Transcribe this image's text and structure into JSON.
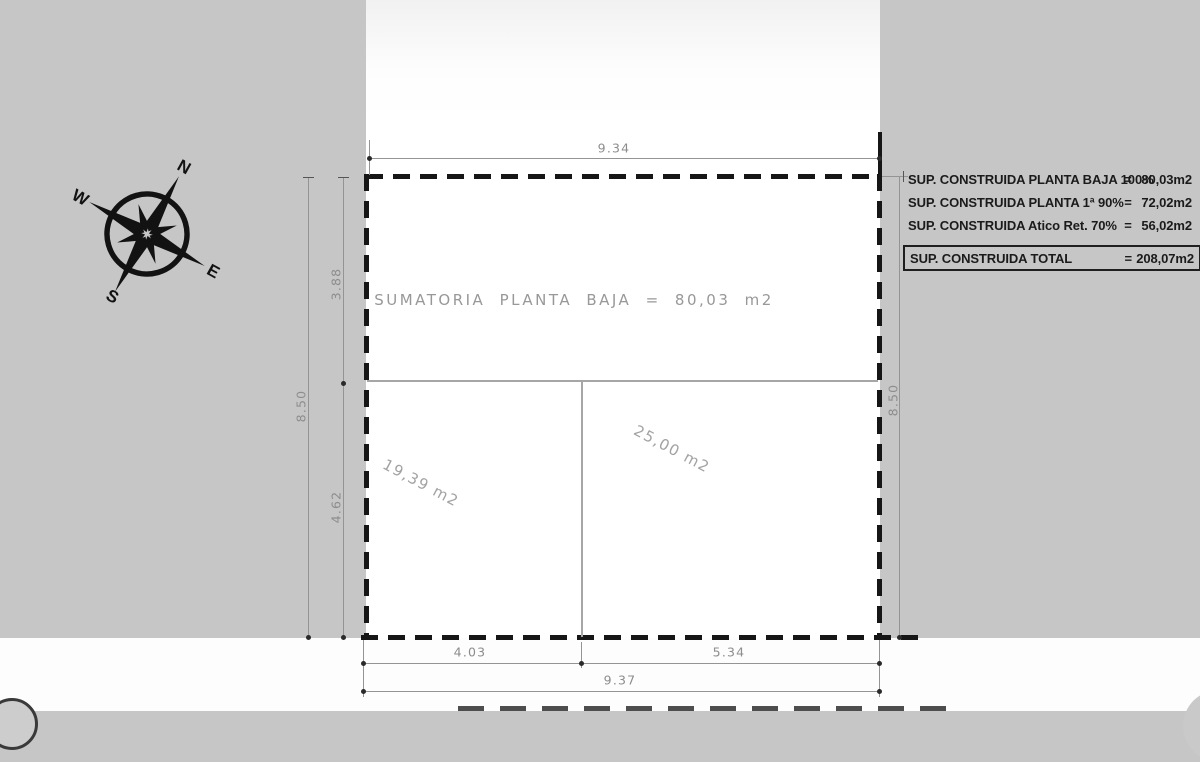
{
  "compass": {
    "north": "N",
    "east": "E",
    "south": "S",
    "west": "W"
  },
  "plan": {
    "summary_label": "SUMATORIA PLANTA BAJA = 80,03 m2",
    "rooms": [
      {
        "area": "19,39 m2"
      },
      {
        "area": "25,00 m2"
      }
    ]
  },
  "dimensions": {
    "top_width": "9.34",
    "left_total": "8.50",
    "left_upper": "3.88",
    "left_lower": "4.62",
    "right_total": "8.50",
    "bottom_left": "4.03",
    "bottom_right": "5.34",
    "bottom_total": "9.37"
  },
  "area_table": {
    "rows": [
      {
        "label": "SUP. CONSTRUIDA PLANTA BAJA 100%",
        "eq": "=",
        "value": "80,03m2"
      },
      {
        "label": "SUP. CONSTRUIDA PLANTA 1ª 90%",
        "eq": "=",
        "value": "72,02m2"
      },
      {
        "label": "SUP. CONSTRUIDA Atico Ret.  70%",
        "eq": "=",
        "value": "56,02m2"
      }
    ],
    "total": {
      "label": "SUP. CONSTRUIDA TOTAL",
      "eq": "=",
      "value": "208,07m2"
    }
  },
  "colors": {
    "background": "#c6c6c6",
    "paper": "#ffffff",
    "boundary": "#161616",
    "dimension_lines": "#949494",
    "dimension_text": "#8d8d8d",
    "table_text": "#1b1b1b"
  }
}
